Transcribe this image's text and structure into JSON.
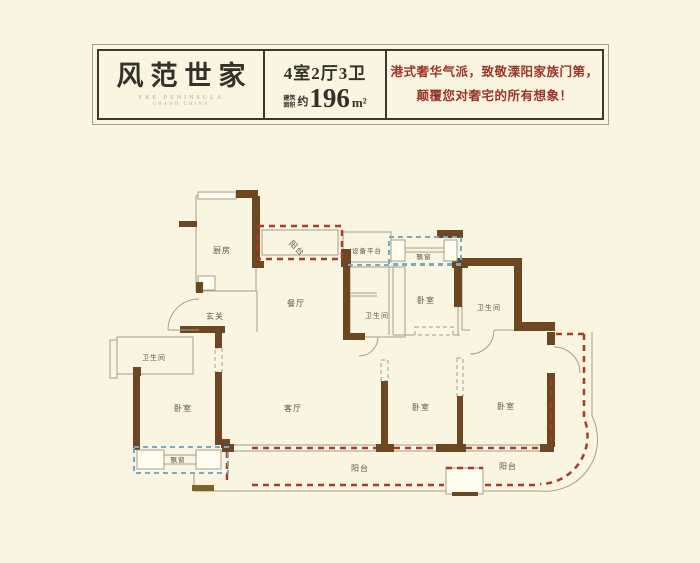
{
  "header": {
    "logo": {
      "title": "风范世家",
      "subtitle_1": "YKE PENINSULA",
      "subtitle_2": "GRAND CHINA"
    },
    "spec": {
      "layout": "4室2厅3卫",
      "area_label_line1": "建筑",
      "area_label_line2": "面积",
      "area_approx": "约",
      "area_value": "196",
      "area_unit": "m²"
    },
    "slogan": {
      "line1": "港式奢华气派，致敬溧阳家族门第，",
      "line2": "颠覆您对奢宅的所有想象！"
    }
  },
  "plan": {
    "labels": {
      "kitchen": "厨房",
      "balcony": "阳台",
      "equipment_platform": "设备平台",
      "bay_window": "飘窗",
      "bedroom": "卧室",
      "bathroom": "卫生间",
      "dining": "餐厅",
      "entry": "玄关",
      "living": "客厅"
    },
    "colors": {
      "background": "#f9f5e1",
      "wall": "#6d4721",
      "outline": "#a39f8d",
      "balcony_dash_red": "#a93b28",
      "bay_window_dash_blue": "#73abc9",
      "label_text": "#63523f",
      "header_border": "#3b392e",
      "slogan_red": "#9d3426"
    }
  }
}
